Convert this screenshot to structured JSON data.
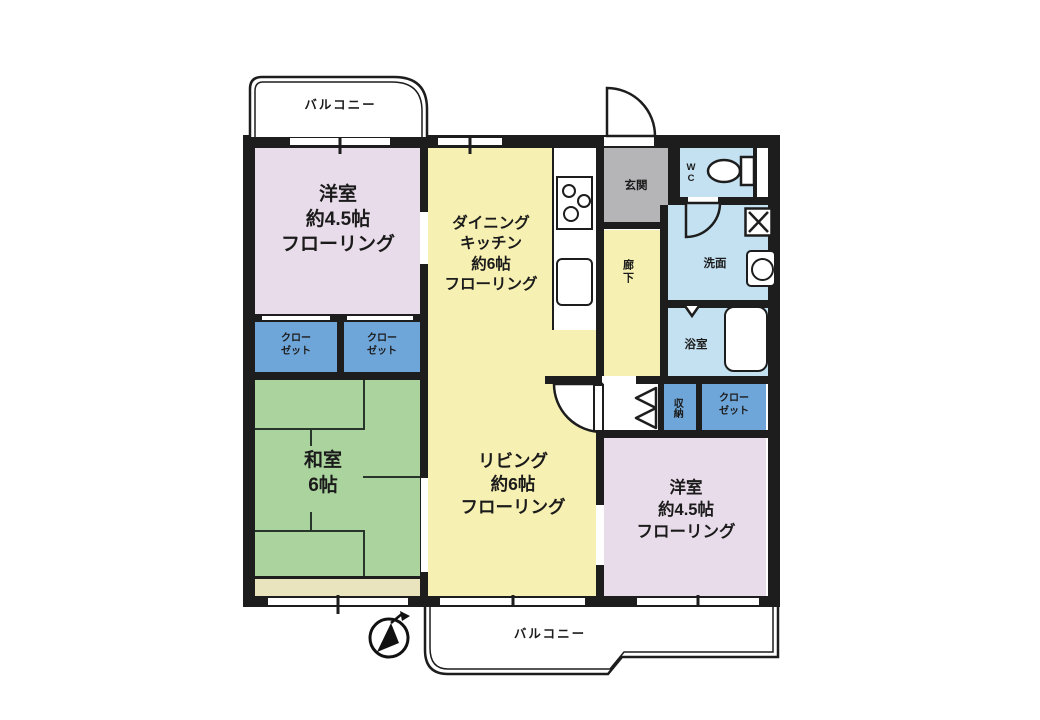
{
  "plan": {
    "type": "apartment-floor-plan",
    "balcony_top": {
      "label": "バルコニー"
    },
    "balcony_bottom": {
      "label": "バルコニー"
    },
    "rooms": {
      "bedroom_nw": {
        "lines": [
          "洋室",
          "約4.5帖",
          "フローリング"
        ]
      },
      "dining_kitchen": {
        "lines": [
          "ダイニング",
          "キッチン",
          "約6帖",
          "フローリング"
        ]
      },
      "living": {
        "lines": [
          "リビング",
          "約6帖",
          "フローリング"
        ]
      },
      "japanese_room": {
        "lines": [
          "和室",
          "6帖"
        ]
      },
      "bedroom_se": {
        "lines": [
          "洋室",
          "約4.5帖",
          "フローリング"
        ]
      },
      "entrance": {
        "label": "玄関"
      },
      "corridor": {
        "label": "廊下"
      },
      "wc": {
        "label": "WC"
      },
      "washroom": {
        "label": "洗面"
      },
      "bathroom": {
        "label": "浴室"
      },
      "storage": {
        "label": "収納"
      },
      "closet_nw": {
        "lines": [
          "クロー",
          "ゼット"
        ]
      },
      "closet_n": {
        "lines": [
          "クロー",
          "ゼット"
        ]
      },
      "closet_e": {
        "lines": [
          "クロー",
          "ゼット"
        ]
      }
    },
    "fixtures": [
      "compass-north-icon",
      "stove-icon",
      "kitchen-sink-icon",
      "toilet-icon",
      "washing-machine-icon",
      "basin-icon",
      "bathtub-icon",
      "door-arc-icon",
      "bifold-door-icon"
    ],
    "colors": {
      "wall": "#1d1d1d",
      "western_room": "#e9dcea",
      "wood_floor": "#f6f0b2",
      "tatami_green": "#abd39e",
      "tatami_edge_strip": "#e9e4bd",
      "wet_area_blue": "#c4e1f1",
      "closet_blue": "#6fa6d9",
      "entrance_gray": "#b5b5b7"
    }
  }
}
